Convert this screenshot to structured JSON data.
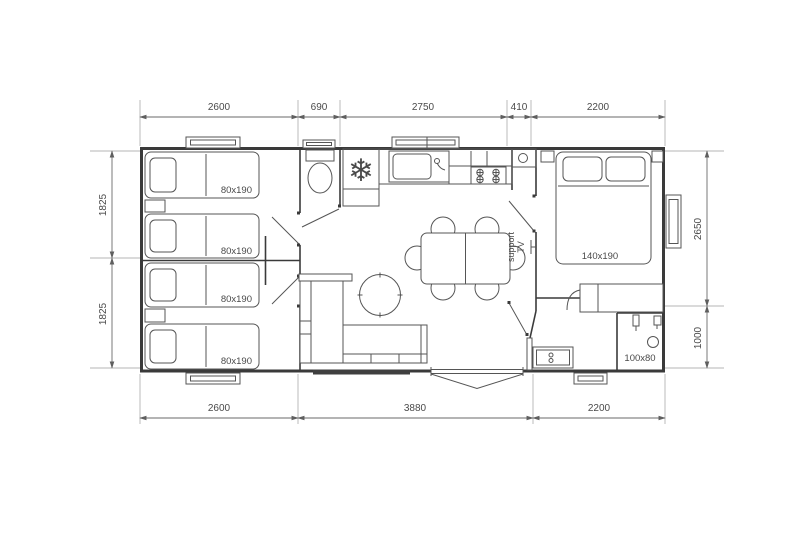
{
  "plan": {
    "kind": "mobile-home floor plan",
    "colors": {
      "wall": "#3a3a3a",
      "furniture": "#555555",
      "dimension_text": "#4a4a4a",
      "snowflake_blue": "#3b4fa3",
      "background": "#ffffff"
    },
    "dimensions": {
      "top": [
        "2600",
        "690",
        "2750",
        "410",
        "2200"
      ],
      "bottom": [
        "2600",
        "3880",
        "2200"
      ],
      "left": [
        "1825",
        "1825"
      ],
      "right": [
        "2650",
        "1000"
      ]
    },
    "labels": {
      "single_beds": [
        "80x190",
        "80x190",
        "80x190",
        "80x190"
      ],
      "double_bed": "140x190",
      "shower": "100x80",
      "tv_line1": "support",
      "tv_line2": "TV"
    },
    "icons": {
      "fridge_snowflake": "❄"
    }
  }
}
